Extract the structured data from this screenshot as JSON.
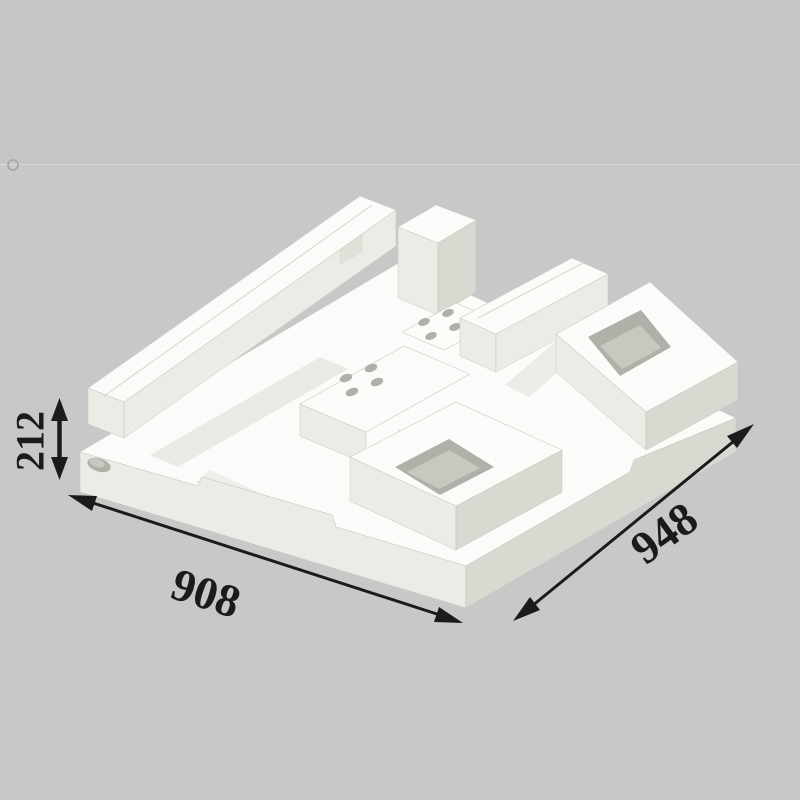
{
  "illustration": {
    "description": "Isometric CAD rendering of a white molded foam packaging insert (pallet-style block with pockets, channels and vent holes) on a gray background",
    "palette": {
      "background_top": "#c5c5c5",
      "background_bottom": "#c8c8c8",
      "divider_line": "#d7d7d7",
      "circle_marker": "#9aa0aa",
      "face_top": "#fbfbf9",
      "face_front": "#ecece6",
      "face_side": "#d9d9d1",
      "face_inner": "#c8c8c0",
      "hole_depth": "#b0b0a8",
      "annotation": "#1b1b1b"
    }
  },
  "dimensions": {
    "height": {
      "value": "212"
    },
    "front_left_edge": {
      "value": "908"
    },
    "front_right_edge": {
      "value": "948"
    }
  }
}
